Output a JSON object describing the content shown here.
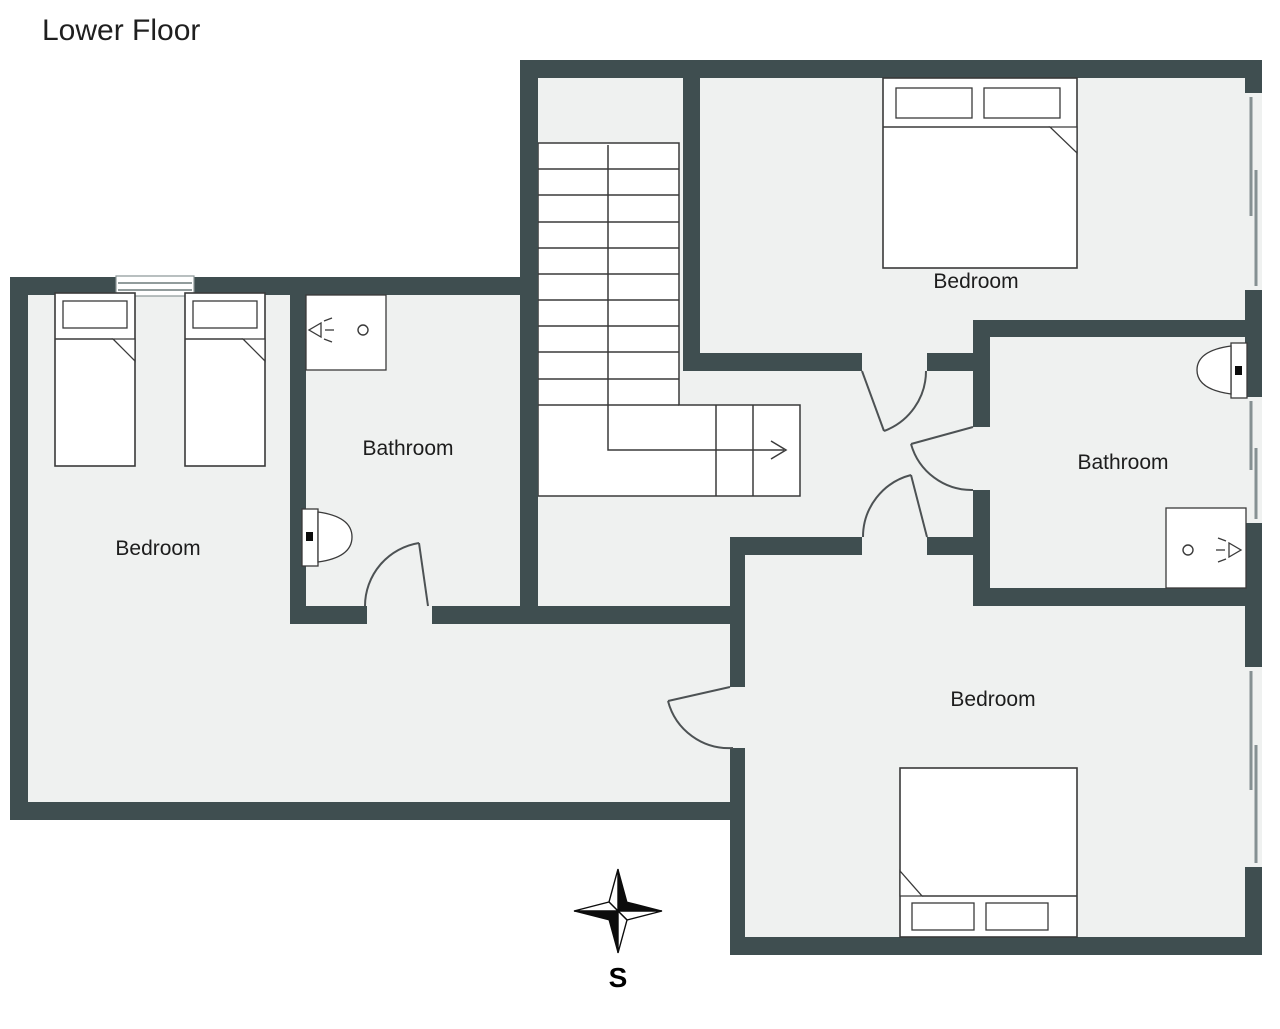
{
  "title": "Lower Floor",
  "floor_plan": {
    "rooms": [
      {
        "id": "bedroom-left",
        "label": "Bedroom"
      },
      {
        "id": "bathroom-left",
        "label": "Bathroom"
      },
      {
        "id": "bedroom-top-right",
        "label": "Bedroom"
      },
      {
        "id": "bathroom-right",
        "label": "Bathroom"
      },
      {
        "id": "bedroom-bottom-right",
        "label": "Bedroom"
      }
    ],
    "fixtures": {
      "beds": [
        "twin-bed",
        "twin-bed",
        "double-bed",
        "double-bed"
      ],
      "toilets": 2,
      "showers": 2,
      "staircase": "double flight with direction arrow",
      "doors": 5,
      "windows": 4
    },
    "compass": {
      "label": "S"
    }
  },
  "palette": {
    "wall": "#3f4e50",
    "floor": "#eff1f0",
    "outline": "#3a3a3a",
    "door_arc": "#4d5254",
    "background": "#ffffff",
    "text": "#1d1d1d"
  }
}
